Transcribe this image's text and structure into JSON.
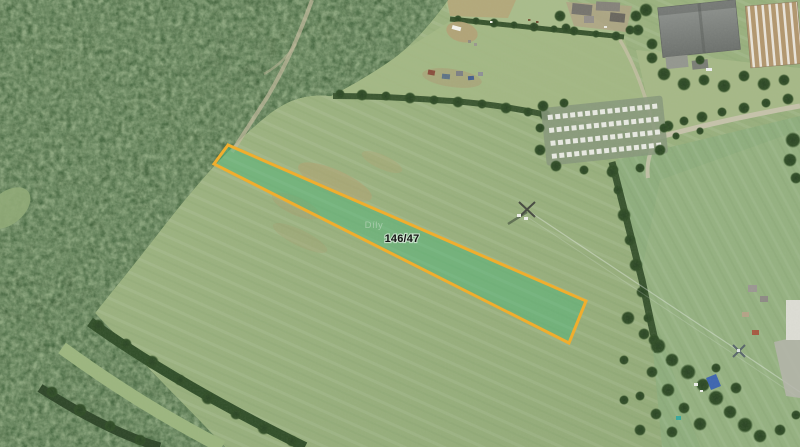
{
  "map": {
    "view": "satellite-orthophoto",
    "parcel": {
      "label": "146/47",
      "points": "228,145 214,164 569,343 586,301",
      "outline_color": "#f0ae2e",
      "fill_color": "rgba(62,182,120,0.40)"
    },
    "place_label": "Díly",
    "legend_colors": {
      "field": "#99b07e",
      "field_right": "#8fae7e",
      "forest": "#41603a",
      "hedgerow": "#35502c",
      "road": "#c9c3ae",
      "parcel_outline": "#f0ae2e"
    }
  }
}
